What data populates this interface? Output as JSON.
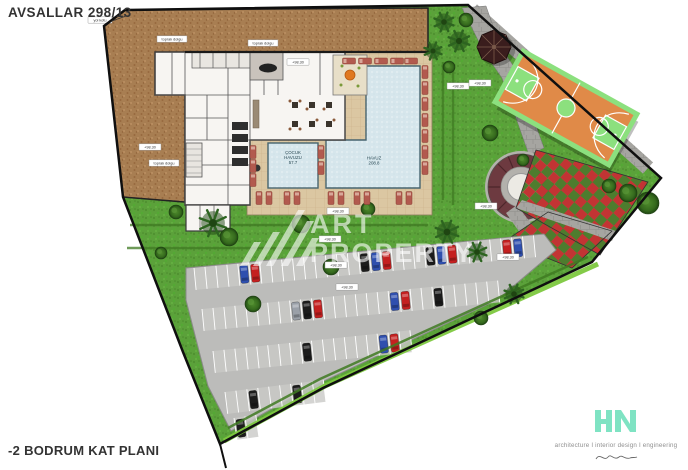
{
  "title": "AVSALLAR 298/13",
  "caption": "-2 BODRUM KAT PLANI",
  "watermark": {
    "word1": "ART",
    "word2": "PROPERTY"
  },
  "brand": {
    "name": "HN",
    "tagline": "architecture I interior design I engineering"
  },
  "colors": {
    "earth": "#a87e52",
    "lawn": "#5ba13a",
    "deck": "#dbc7a2",
    "pool": "#d6e6ec",
    "court_orange": "#e08a48",
    "court_green": "#8ce07e",
    "plaza_maroon": "#6d3a40",
    "asphalt": "#bcbcba",
    "hedge": "#7dc83f",
    "stone": "#a6a5a1",
    "brand_mint": "#7fe3c3"
  },
  "pools": [
    {
      "x": 293,
      "y": 159,
      "lines": [
        "ÇOCUK",
        "HAVUZU",
        "57.7"
      ]
    },
    {
      "x": 374,
      "y": 162,
      "lines": [
        "HAVUZ",
        "208.8"
      ]
    }
  ],
  "site_labels": [
    {
      "x": 100,
      "y": 20,
      "w": 24,
      "text": "yol kotu"
    },
    {
      "x": 172,
      "y": 39,
      "w": 30,
      "text": "toprak dolgu"
    },
    {
      "x": 263,
      "y": 43,
      "w": 30,
      "text": "toprak dolgu"
    },
    {
      "x": 298,
      "y": 62,
      "w": 22,
      "text": "+98.30"
    },
    {
      "x": 150,
      "y": 147,
      "w": 22,
      "text": "+98.30"
    },
    {
      "x": 164,
      "y": 163,
      "w": 30,
      "text": "toprak dolgu"
    },
    {
      "x": 338,
      "y": 211,
      "w": 22,
      "text": "+98.30"
    },
    {
      "x": 330,
      "y": 239,
      "w": 22,
      "text": "+98.30"
    },
    {
      "x": 336,
      "y": 265,
      "w": 22,
      "text": "+98.30"
    },
    {
      "x": 347,
      "y": 287,
      "w": 22,
      "text": "+98.30"
    },
    {
      "x": 458,
      "y": 86,
      "w": 22,
      "text": "+98.30"
    },
    {
      "x": 480,
      "y": 83,
      "w": 22,
      "text": "+98.30"
    },
    {
      "x": 486,
      "y": 206,
      "w": 22,
      "text": "+98.30"
    },
    {
      "x": 508,
      "y": 257,
      "w": 22,
      "text": "+98.30"
    }
  ],
  "vegetation": [
    {
      "x": 444,
      "y": 22,
      "r": 10,
      "k": "palm"
    },
    {
      "x": 459,
      "y": 41,
      "r": 11,
      "k": "palm"
    },
    {
      "x": 433,
      "y": 51,
      "r": 9,
      "k": "palm"
    },
    {
      "x": 449,
      "y": 67,
      "r": 6,
      "k": "bush"
    },
    {
      "x": 466,
      "y": 20,
      "r": 7,
      "k": "bush"
    },
    {
      "x": 213,
      "y": 223,
      "r": 14,
      "k": "palm"
    },
    {
      "x": 229,
      "y": 237,
      "r": 9,
      "k": "bush"
    },
    {
      "x": 176,
      "y": 212,
      "r": 7,
      "k": "bush"
    },
    {
      "x": 301,
      "y": 224,
      "r": 9,
      "k": "bush"
    },
    {
      "x": 331,
      "y": 267,
      "r": 8,
      "k": "bush"
    },
    {
      "x": 253,
      "y": 304,
      "r": 8,
      "k": "bush"
    },
    {
      "x": 161,
      "y": 253,
      "r": 6,
      "k": "bush"
    },
    {
      "x": 368,
      "y": 209,
      "r": 7,
      "k": "bush"
    },
    {
      "x": 447,
      "y": 232,
      "r": 12,
      "k": "palm"
    },
    {
      "x": 477,
      "y": 252,
      "r": 10,
      "k": "palm"
    },
    {
      "x": 514,
      "y": 294,
      "r": 10,
      "k": "palm"
    },
    {
      "x": 481,
      "y": 318,
      "r": 7,
      "k": "bush"
    },
    {
      "x": 490,
      "y": 133,
      "r": 8,
      "k": "bush"
    },
    {
      "x": 523,
      "y": 160,
      "r": 6,
      "k": "bush"
    },
    {
      "x": 648,
      "y": 203,
      "r": 11,
      "k": "bush"
    },
    {
      "x": 628,
      "y": 193,
      "r": 9,
      "k": "bush"
    },
    {
      "x": 609,
      "y": 186,
      "r": 7,
      "k": "bush"
    }
  ],
  "loungers": [
    {
      "x": 425,
      "y": 72,
      "o": "v"
    },
    {
      "x": 425,
      "y": 88,
      "o": "v"
    },
    {
      "x": 425,
      "y": 104,
      "o": "v"
    },
    {
      "x": 425,
      "y": 120,
      "o": "v"
    },
    {
      "x": 425,
      "y": 136,
      "o": "v"
    },
    {
      "x": 425,
      "y": 152,
      "o": "v"
    },
    {
      "x": 425,
      "y": 168,
      "o": "v"
    },
    {
      "x": 349,
      "y": 61,
      "o": "h"
    },
    {
      "x": 365,
      "y": 61,
      "o": "h"
    },
    {
      "x": 381,
      "y": 61,
      "o": "h"
    },
    {
      "x": 397,
      "y": 61,
      "o": "h"
    },
    {
      "x": 411,
      "y": 61,
      "o": "h"
    },
    {
      "x": 321,
      "y": 152,
      "o": "v"
    },
    {
      "x": 321,
      "y": 168,
      "o": "v"
    },
    {
      "x": 253,
      "y": 152,
      "o": "v"
    },
    {
      "x": 253,
      "y": 166,
      "o": "v"
    },
    {
      "x": 253,
      "y": 180,
      "o": "v"
    },
    {
      "x": 259,
      "y": 198,
      "o": "v"
    },
    {
      "x": 269,
      "y": 198,
      "o": "v"
    },
    {
      "x": 287,
      "y": 198,
      "o": "v"
    },
    {
      "x": 297,
      "y": 198,
      "o": "v"
    },
    {
      "x": 331,
      "y": 198,
      "o": "v"
    },
    {
      "x": 341,
      "y": 198,
      "o": "v"
    },
    {
      "x": 357,
      "y": 198,
      "o": "v"
    },
    {
      "x": 367,
      "y": 198,
      "o": "v"
    },
    {
      "x": 399,
      "y": 198,
      "o": "v"
    },
    {
      "x": 409,
      "y": 198,
      "o": "v"
    }
  ],
  "parking": {
    "stall_w": 11,
    "depth": 22,
    "rows": [
      {
        "x": 194,
        "y": 268,
        "angle": -5.5,
        "stalls": 31,
        "cars": [
          [
            4,
            "blue"
          ],
          [
            5,
            "red"
          ],
          [
            15,
            "black"
          ],
          [
            16,
            "blue"
          ],
          [
            17,
            "red"
          ],
          [
            21,
            "black"
          ],
          [
            22,
            "blue"
          ],
          [
            23,
            "red"
          ],
          [
            28,
            "red"
          ],
          [
            29,
            "blue"
          ]
        ]
      },
      {
        "x": 202,
        "y": 309,
        "angle": -5.5,
        "stalls": 27,
        "cars": [
          [
            8,
            "silver"
          ],
          [
            9,
            "black"
          ],
          [
            10,
            "red"
          ],
          [
            17,
            "blue"
          ],
          [
            18,
            "red"
          ],
          [
            21,
            "black"
          ]
        ]
      },
      {
        "x": 213,
        "y": 351,
        "angle": -6,
        "stalls": 18,
        "cars": [
          [
            8,
            "black"
          ],
          [
            15,
            "blue"
          ],
          [
            16,
            "red"
          ]
        ]
      },
      {
        "x": 225,
        "y": 392,
        "angle": -7,
        "stalls": 9,
        "cars": [
          [
            2,
            "black"
          ],
          [
            6,
            "black"
          ]
        ]
      },
      {
        "x": 234,
        "y": 418,
        "angle": -8,
        "stalls": 2,
        "cars": [
          [
            0,
            "black"
          ]
        ]
      }
    ]
  },
  "car_colors": {
    "red": "#c42020",
    "blue": "#2f4fae",
    "black": "#1c1c1c",
    "gray": "#4a4a4a",
    "silver": "#9aa0a8"
  },
  "checker": {
    "red": "#c23434",
    "green": "#4e7c2e",
    "size": 9,
    "angle": 42,
    "cx": 575,
    "cy": 215
  }
}
